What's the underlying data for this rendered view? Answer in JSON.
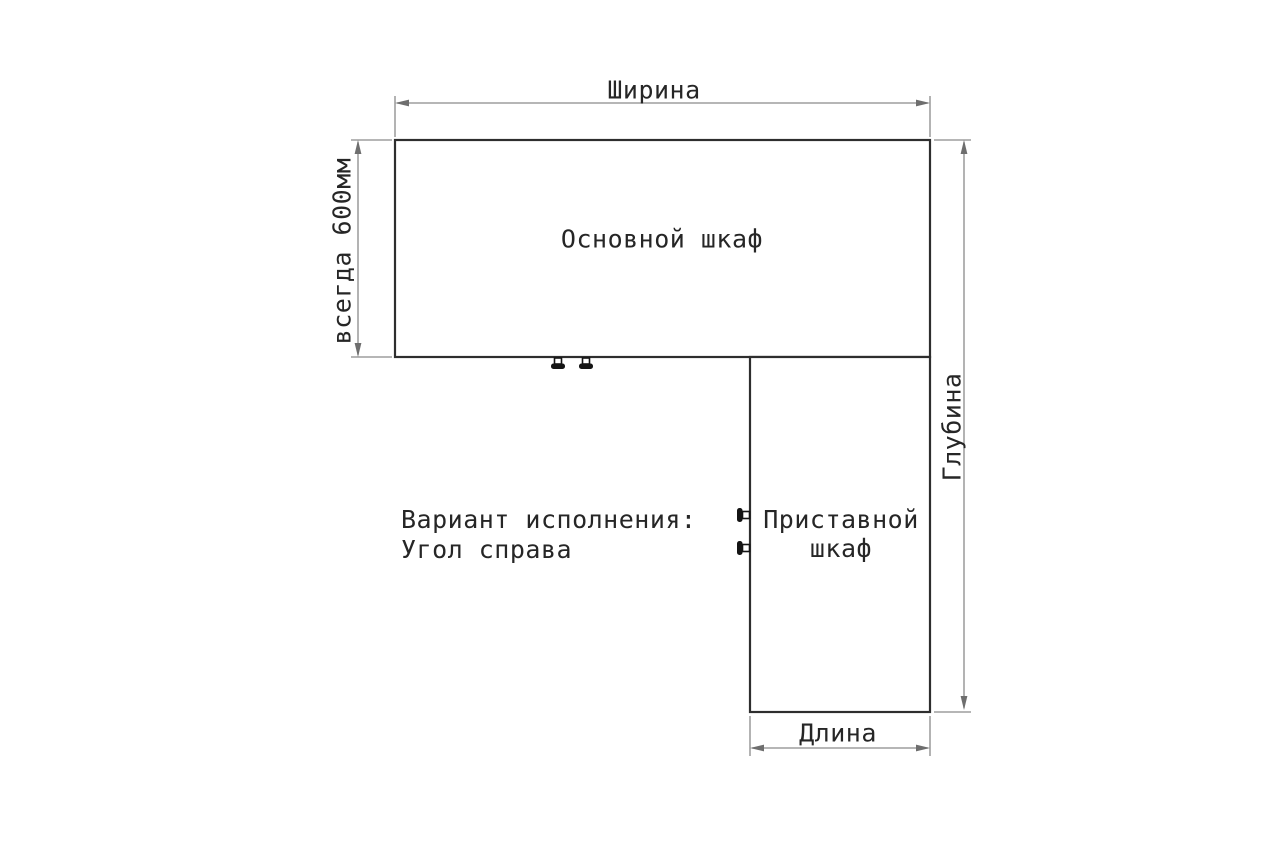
{
  "diagram": {
    "kind": "furniture-corner-layout-scheme",
    "labels": {
      "width_dim": "Ширина",
      "main_cabinet": "Основной шкаф",
      "left_dim": "всегда 600мм",
      "depth_dim": "Глубина",
      "side_cabinet": "Приставной\nшкаф",
      "variant_note": "Вариант исполнения:\nУгол справа",
      "length_dim": "Длина"
    },
    "colors": {
      "background": "#ffffff",
      "panel_outline": "#2e2e2e",
      "dimension_line": "#8a8a8a",
      "text": "#262626",
      "connector": "#141414"
    }
  }
}
